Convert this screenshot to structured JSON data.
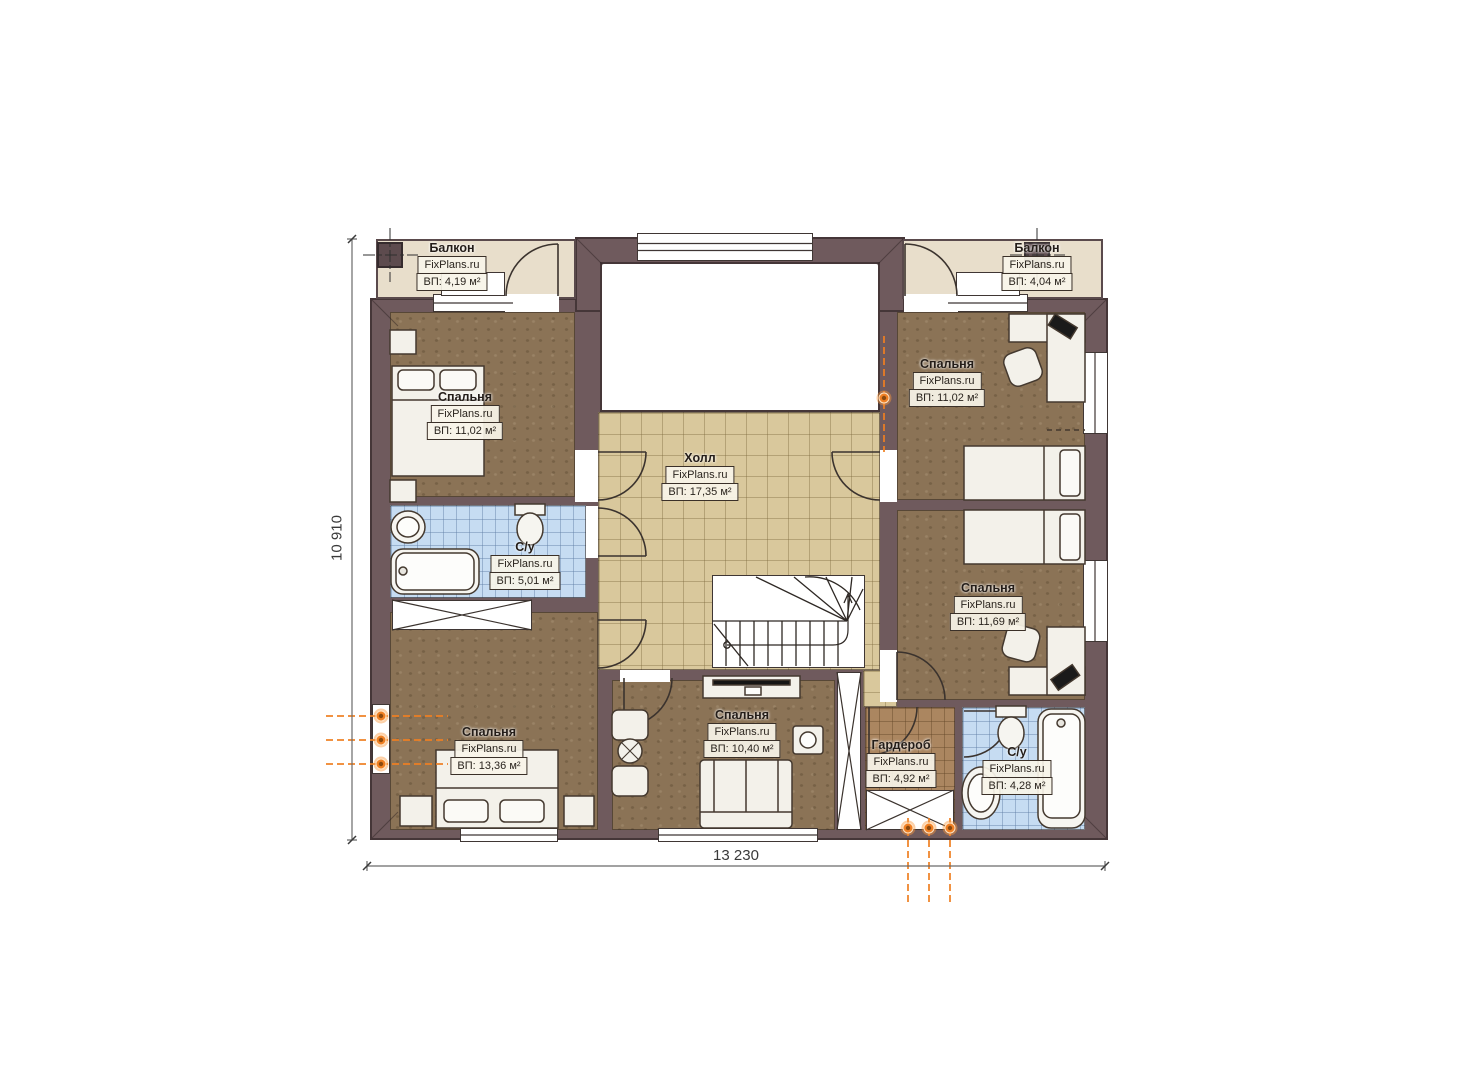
{
  "plan": {
    "watermark": "FixPlans.ru",
    "dimensions": {
      "width": "13 230",
      "height": "10 910"
    },
    "rooms": [
      {
        "id": "balcony-left",
        "name": "Балкон",
        "area": "ВП: 4,19 м²"
      },
      {
        "id": "balcony-right",
        "name": "Балкон",
        "area": "ВП: 4,04 м²"
      },
      {
        "id": "bedroom-top-left",
        "name": "Спальня",
        "area": "ВП: 11,02 м²"
      },
      {
        "id": "bedroom-top-right",
        "name": "Спальня",
        "area": "ВП: 11,02 м²"
      },
      {
        "id": "hall",
        "name": "Холл",
        "area": "ВП: 17,35 м²"
      },
      {
        "id": "bathroom-left",
        "name": "С/у",
        "area": "ВП: 5,01 м²"
      },
      {
        "id": "bedroom-right",
        "name": "Спальня",
        "area": "ВП: 11,69 м²"
      },
      {
        "id": "bedroom-bottom-left",
        "name": "Спальня",
        "area": "ВП: 13,36 м²"
      },
      {
        "id": "bedroom-bottom-mid",
        "name": "Спальня",
        "area": "ВП: 10,40 м²"
      },
      {
        "id": "wardrobe",
        "name": "Гардероб",
        "area": "ВП: 4,92 м²"
      },
      {
        "id": "bathroom-right",
        "name": "С/у",
        "area": "ВП: 4,28 м²"
      }
    ],
    "colors": {
      "wall": "#6f5a5d",
      "balcony_floor": "#e8decb",
      "bedroom_floor": "#8b7356",
      "hall_tile": "#d9c89c",
      "bathroom_tile": "#c6dcf2",
      "wardrobe_tile": "#ab8660",
      "accent_orange": "#f08024"
    }
  }
}
